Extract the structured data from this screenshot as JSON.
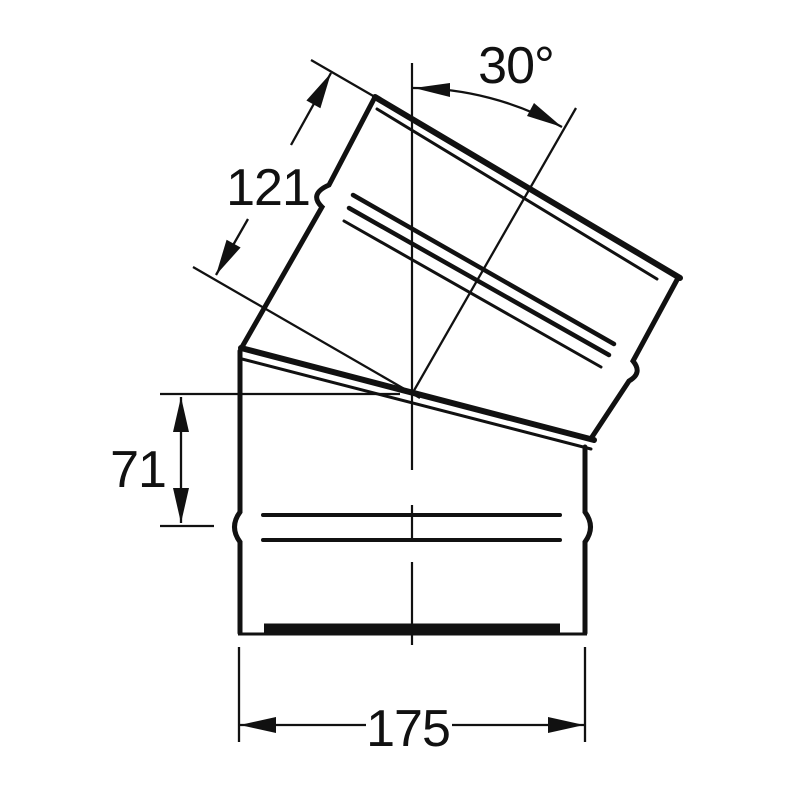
{
  "page": {
    "background_color": "#ffffff",
    "ink_color": "#111111"
  },
  "drawing": {
    "dimensions": {
      "angle": "30°",
      "upper_segment_length": "121",
      "lower_segment_height": "71",
      "width": "175"
    }
  }
}
